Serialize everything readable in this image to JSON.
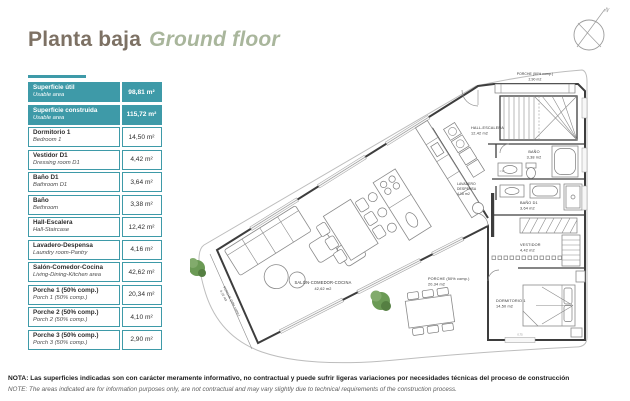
{
  "page": {
    "title_es": "Planta baja",
    "title_en": "Ground floor"
  },
  "colors": {
    "accent_teal": "#3e9aa8",
    "title_brown": "#7d7164",
    "title_sage": "#a9b69c",
    "tree_green": "#6b9a55"
  },
  "area_table": {
    "rows": [
      {
        "es": "Superficie útil",
        "en": "Usable area",
        "value": "98,81 m²"
      },
      {
        "es": "Superficie construida",
        "en": "Usable area",
        "value": "115,72 m²"
      },
      {
        "es": "Dormitorio 1",
        "en": "Bedroom 1",
        "value": "14,50 m²"
      },
      {
        "es": "Vestidor D1",
        "en": "Dressing room D1",
        "value": "4,42 m²"
      },
      {
        "es": "Baño D1",
        "en": "Bathroom D1",
        "value": "3,64 m²"
      },
      {
        "es": "Baño",
        "en": "Bethroom",
        "value": "3,38 m²"
      },
      {
        "es": "Hall-Escalera",
        "en": "Hall-Staircase",
        "value": "12,42 m²"
      },
      {
        "es": "Lavadero-Despensa",
        "en": "Laundry room-Pantry",
        "value": "4,16 m²"
      },
      {
        "es": "Salón-Comedor-Cocina",
        "en": "Living-Dining-Kitchen area",
        "value": "42,62 m²"
      },
      {
        "es": "Porche 1 (50% comp.)",
        "en": "Porch 1 (50% comp.)",
        "value": "20,34 m²"
      },
      {
        "es": "Porche 2 (50% comp.)",
        "en": "Porch 2 (50% comp.)",
        "value": "4,10 m²"
      },
      {
        "es": "Porche 3 (50% comp.)",
        "en": "Porch 3 (50% comp.)",
        "value": "2,90 m²"
      }
    ]
  },
  "plan": {
    "compass_label": "N",
    "rooms": {
      "porche3": {
        "name": "PORCHE (50% comp.)",
        "area": "2,90 m2"
      },
      "hall": {
        "name": "HALL-ESCALERA",
        "area": "12,42 m2"
      },
      "bano": {
        "name": "BAÑO",
        "area": "3,38 m2"
      },
      "lavadero": {
        "name_line1": "LAVADERO",
        "name_line2": "DESPENSA",
        "area": "4,16 m2"
      },
      "bano_d1": {
        "name": "BAÑO D1",
        "area": "3,64 m2"
      },
      "vestidor": {
        "name": "VESTIDOR",
        "area": "4,42 m2"
      },
      "dormitorio": {
        "name": "DORMITORIO 1",
        "area": "14,50 m2"
      },
      "porche1": {
        "name": "PORCHE (50% comp.)",
        "area": "20,34 m2"
      },
      "salon": {
        "name": "SALÓN-COMEDOR-COCINA",
        "area": "42,62 m2"
      },
      "porche2": {
        "name": "PORCHE (50% comp.)",
        "area": "4,10 m2"
      }
    },
    "dimensions": [
      "1,93",
      "0,75"
    ]
  },
  "footer": {
    "nota": "NOTA: Las superficies indicadas son con carácter meramente informativo, no contractual y puede sufrir ligeras variaciones por necesidades técnicas del proceso de construcción",
    "note": "NOTE: The areas indicated are for information purposes only, are not contractual and may vary slightly due to technical requirements of the construction process."
  }
}
